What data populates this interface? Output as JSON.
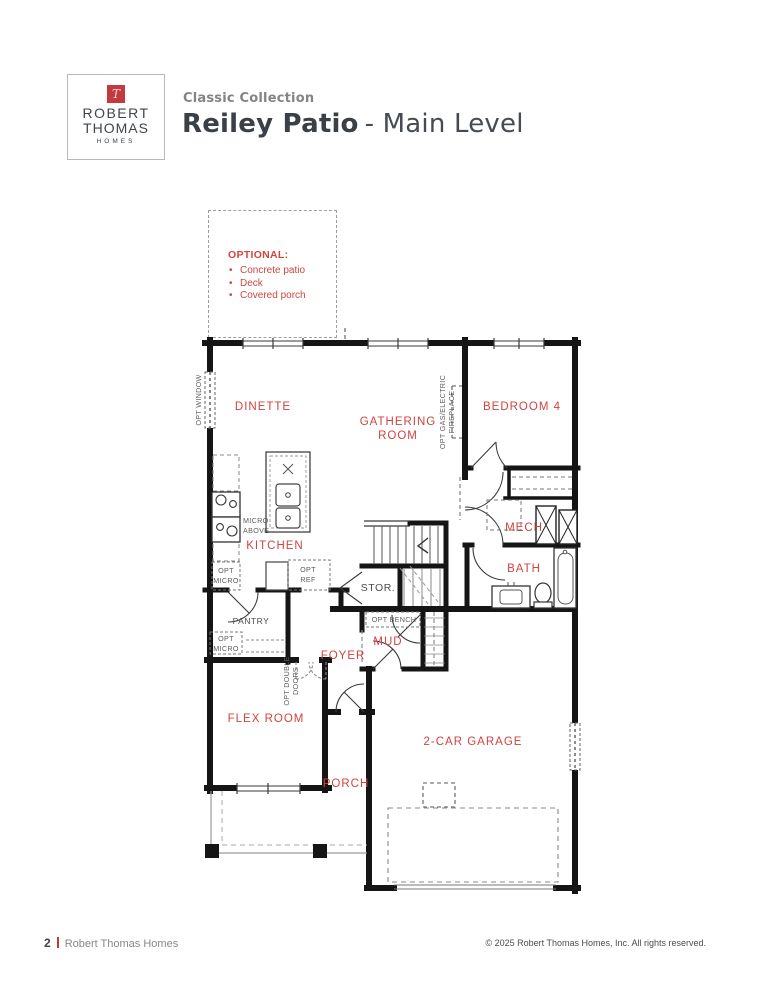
{
  "header": {
    "logo": {
      "monogram": "T",
      "name_line1": "ROBERT",
      "name_line2": "THOMAS",
      "name_line3": "HOMES"
    },
    "collection": "Classic Collection",
    "plan_name": "Reiley Patio",
    "plan_suffix": "- Main Level"
  },
  "optional_callout": {
    "title": "OPTIONAL:",
    "items": [
      "Concrete patio",
      "Deck",
      "Covered porch"
    ]
  },
  "floorplan": {
    "rooms": {
      "dinette": "DINETTE",
      "gathering_line1": "GATHERING",
      "gathering_line2": "ROOM",
      "bedroom4": "BEDROOM 4",
      "kitchen": "KITCHEN",
      "mech": "MECH",
      "bath": "BATH",
      "stor": "STOR.",
      "pantry": "PANTRY",
      "foyer": "FOYER",
      "mud": "MUD",
      "flex": "FLEX ROOM",
      "porch": "PORCH",
      "garage": "2-CAR GARAGE"
    },
    "annotations": {
      "opt_window": "OPT WINDOW",
      "opt_fireplace_line1": "OPT GAS/ELECTRIC",
      "opt_fireplace_line2": "FIREPLACE",
      "micro_above_line1": "MICRO",
      "micro_above_line2": "ABOVE",
      "opt_micro_kitchen_line1": "OPT",
      "opt_micro_kitchen_line2": "MICRO",
      "opt_ref_line1": "OPT",
      "opt_ref_line2": "REF",
      "opt_bench": "OPT BENCH",
      "opt_double_doors_line1": "OPT DOUBLE",
      "opt_double_doors_line2": "DOORS",
      "opt_micro_pantry_line1": "OPT",
      "opt_micro_pantry_line2": "MICRO"
    }
  },
  "footer": {
    "page_number": "2",
    "brand": "Robert Thomas Homes",
    "copyright": "© 2025 Robert Thomas Homes, Inc. All rights reserved."
  },
  "colors": {
    "label_red": "#cf4440",
    "logo_red": "#c23a3f",
    "wall_black": "#151515",
    "charcoal": "#3d4349",
    "gray_text": "#86888b",
    "annotation_gray": "#5c5c5c"
  }
}
